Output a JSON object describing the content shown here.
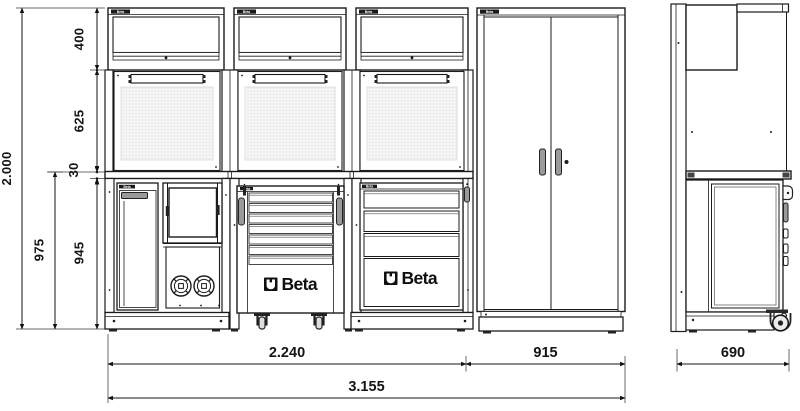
{
  "brand": {
    "beta": "Beta"
  },
  "dimensions": {
    "height_total": "2.000",
    "height_wall_units": "400",
    "height_back_panel": "625",
    "worktop_thickness": "30",
    "height_worktop_level": "975",
    "height_under_worktop": "945",
    "width_bench": "2.240",
    "width_tall_cabinet": "915",
    "width_total": "3.155",
    "depth_side": "690"
  },
  "icons": {
    "power_socket": "circle-cross-socket",
    "caster": "caster-wheel",
    "lock": "keyhole-dot",
    "handle": "grip-bar",
    "tool_rail": "holder-rail"
  },
  "accent_colors": {
    "line": "#1b1b1b",
    "pegboard_dot": "#c2c2c2",
    "handle_gray": "#9a9a9a"
  }
}
